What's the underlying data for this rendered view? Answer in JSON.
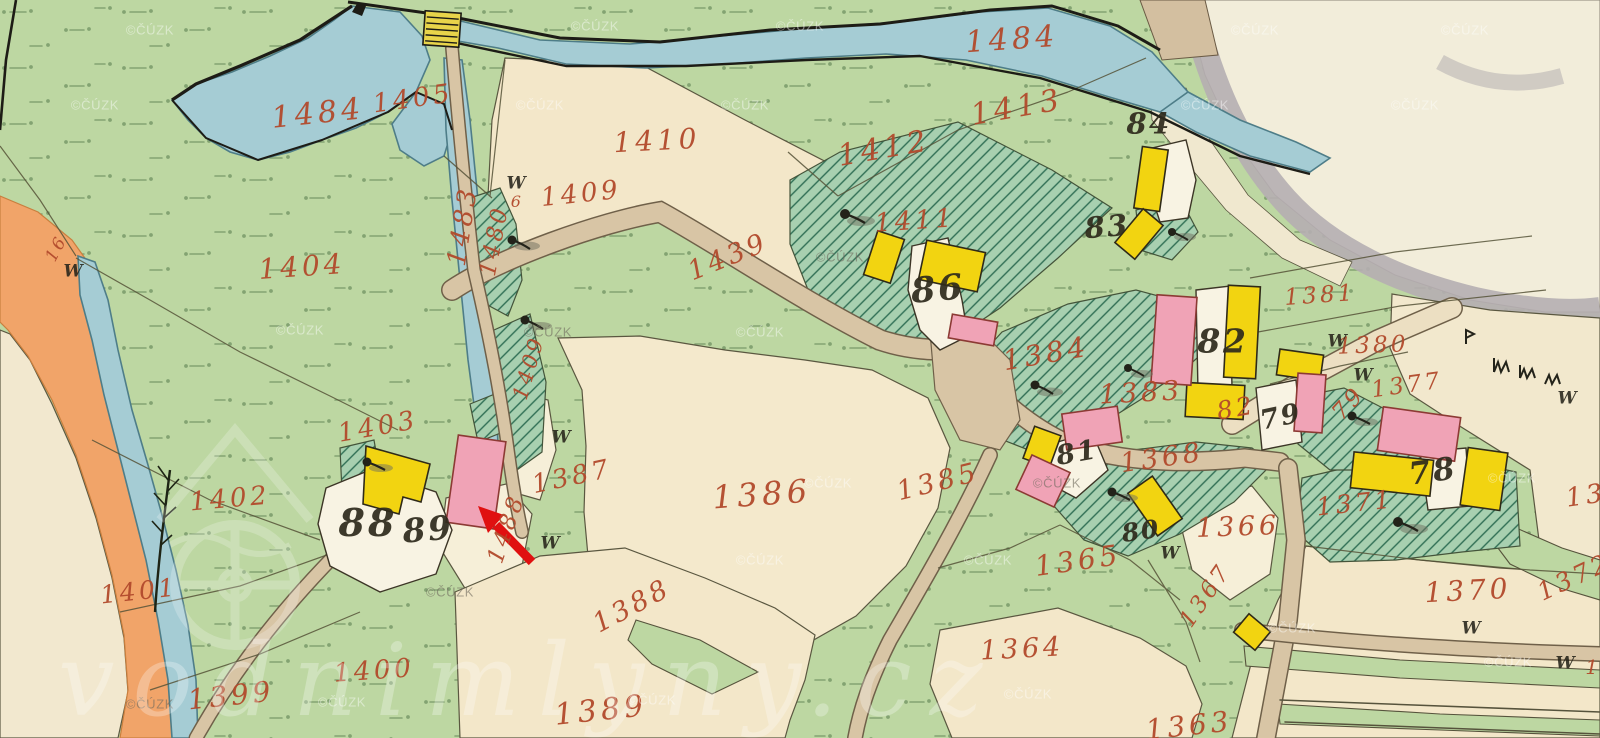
{
  "map": {
    "watermark": {
      "site": "vodnimlyny.cz",
      "copyright": "©ČÚZK"
    },
    "symbols": {
      "meadow": "W"
    },
    "red_labels": [
      "1484",
      "1405",
      "1484",
      "1410",
      "1412",
      "1413",
      "1409",
      "1439",
      "1411",
      "1404",
      "1483",
      "1480",
      "1409",
      "1403",
      "1402",
      "1401",
      "1400",
      "1399",
      "1388",
      "1389",
      "1387",
      "1386",
      "1385",
      "1384",
      "1383",
      "1368",
      "1365",
      "1366",
      "1367",
      "1364",
      "1363",
      "1370",
      "1371",
      "1372",
      "13",
      "1381",
      "1380",
      "1377",
      "79",
      "82",
      "1488",
      "16",
      "6",
      "1"
    ],
    "black_labels": [
      "88",
      "89",
      "86",
      "84",
      "83",
      "82",
      "81",
      "80",
      "79",
      "78"
    ],
    "colors": {
      "field_green": "#bdd7a2",
      "parcel_cream": "#f3e7c9",
      "water_blue": "#a5ccd4",
      "road_tan": "#d8c5a5",
      "wood_hatch_green": "#a8d0b0",
      "building_wood_yellow": "#f2d411",
      "building_masonry_pink": "#f0a3b6",
      "orange_road": "#f1a469",
      "annotation_arrow_red": "#e01010",
      "label_red_ink": "#b24a2c",
      "label_black_ink": "#2e2a1c"
    }
  }
}
